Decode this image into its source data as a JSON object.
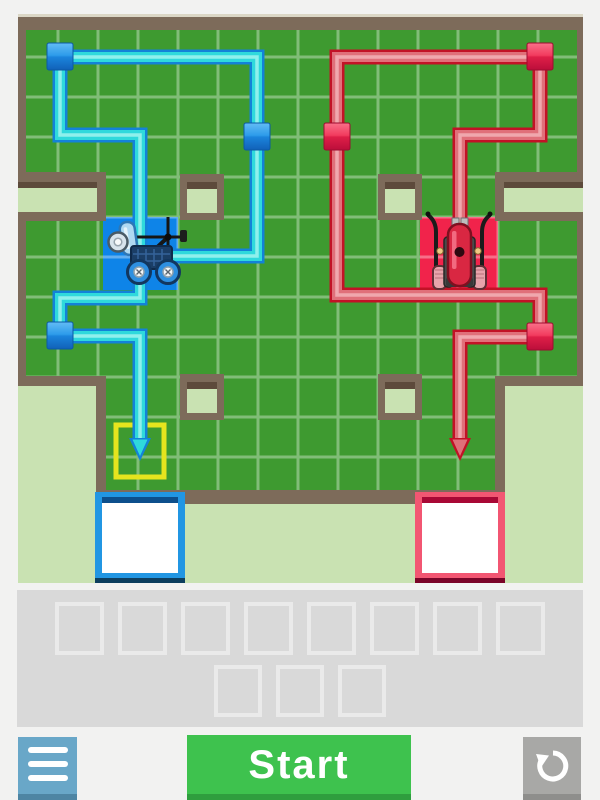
{
  "toolbar": {
    "menu_button": {
      "icon": "hamburger-menu-icon",
      "color": "#69A7C8"
    },
    "start_button": {
      "label": "Start",
      "color": "#3EC24E"
    },
    "reset_button": {
      "icon": "reset-undo-icon",
      "color": "#A8A8A6"
    }
  },
  "program_panel": {
    "background_color": "#D9D9D9",
    "slot_border_color": "#EAEAEA",
    "main_slots": 8,
    "sub_slots": 3
  },
  "playfield": {
    "background_color": "#F2F2F1",
    "grass_color": "#3E9A30",
    "grid_line_color": "rgba(255,255,255,0.35)",
    "wall_color": "#7D6B5A",
    "outside_color": "#C9E2B2",
    "obstacle_blocks": 4,
    "wall_notches": 2,
    "target_highlight_color": "#E6E41E",
    "blue_robot": {
      "cell_color": "#0E84E8",
      "path_edge_color": "#1382D8",
      "path_body_color": "#2FD9DC",
      "waypoint_cubes": 3,
      "finish_box_border_color": "#2196E3"
    },
    "red_robot": {
      "cell_color": "#F1234B",
      "path_edge_color": "#C21226",
      "path_body_color": "#E0707A",
      "waypoint_cubes": 3,
      "finish_box_border_color": "#F25672"
    }
  }
}
